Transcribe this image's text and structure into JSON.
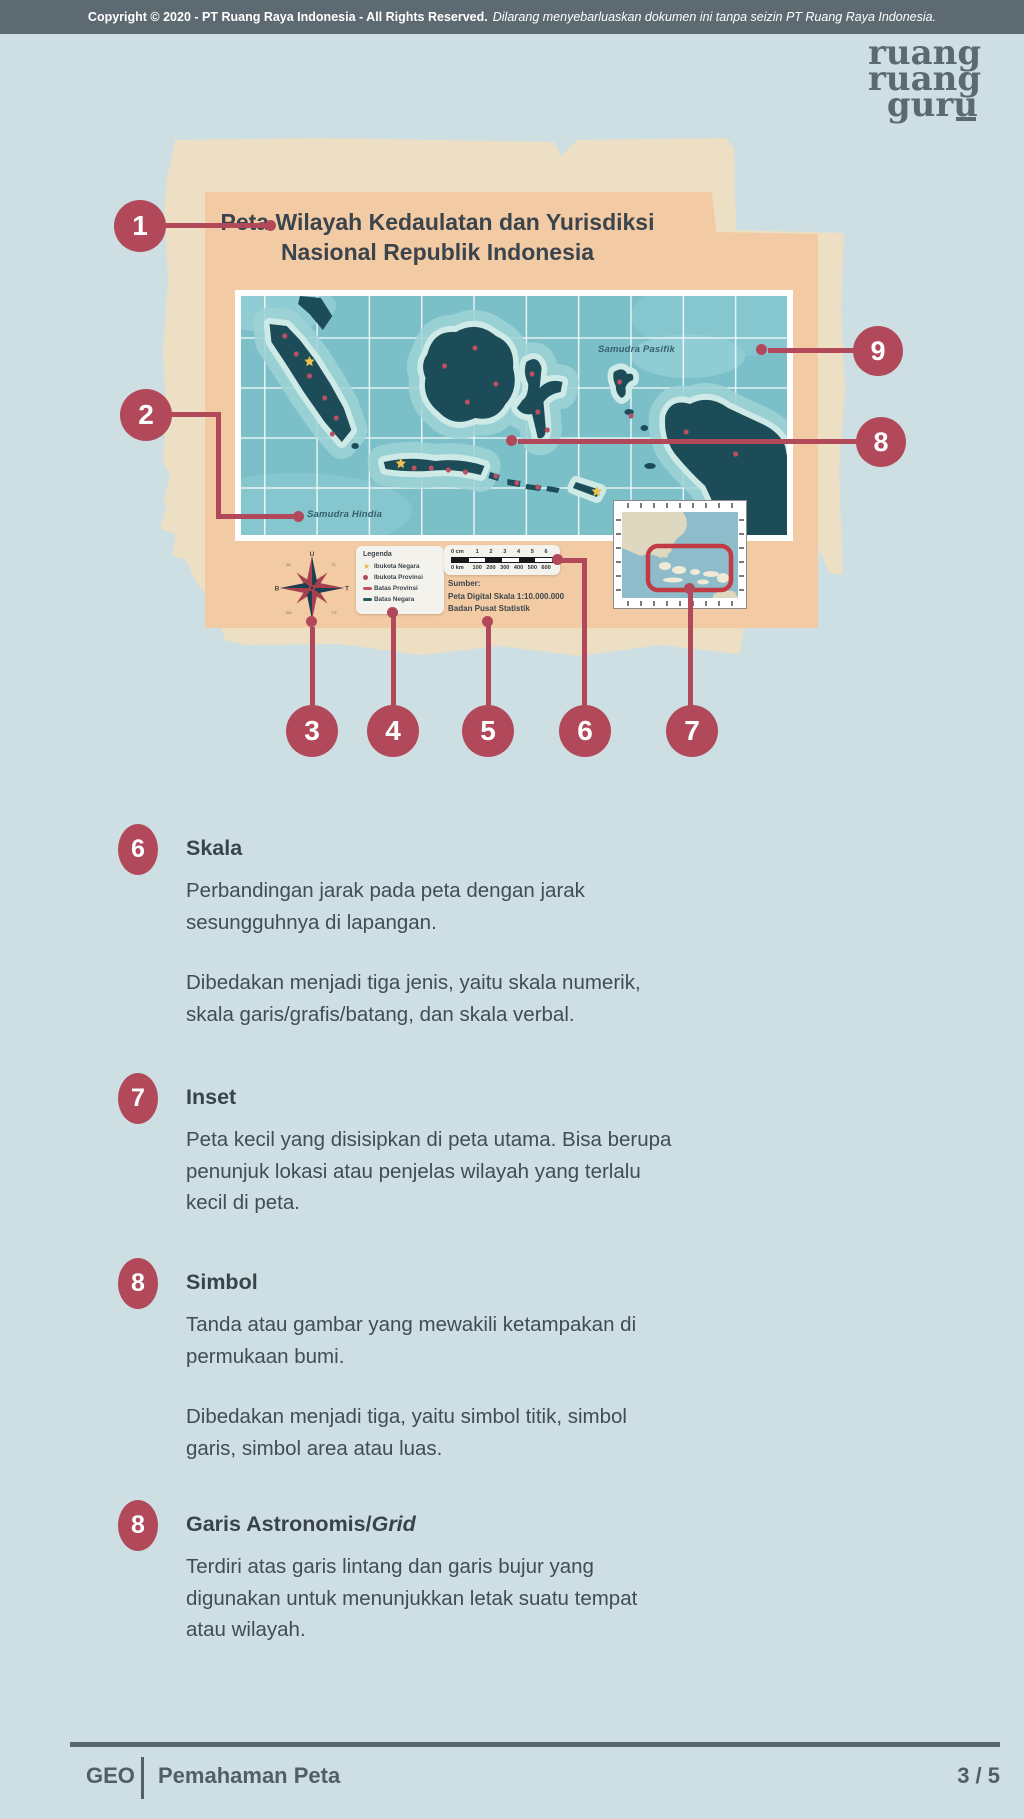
{
  "copyright_bar": {
    "bold": "Copyright © 2020 - PT Ruang Raya Indonesia - All Rights Reserved.",
    "italic": "Dilarang menyebarluaskan dokumen ini tanpa seizin PT Ruang Raya Indonesia."
  },
  "logo": {
    "line1": "ruang",
    "line2": "ruang",
    "line3": "guru"
  },
  "figure": {
    "title_line1": "Peta Wilayah Kedaulatan dan Yurisdiksi",
    "title_line2": "Nasional Republik Indonesia",
    "label_pacific": "Samudra Pasifik",
    "label_indian": "Samudra Hindia",
    "compass": {
      "n": "U",
      "e": "T",
      "s": "S",
      "w": "B",
      "ne": "TL",
      "se": "TG",
      "sw": "BD",
      "nw": "BL"
    },
    "legend": {
      "title": "Legenda",
      "items": [
        {
          "icon": "star",
          "label": "Ibukota Negara"
        },
        {
          "icon": "dot",
          "label": "Ibukota Provinsi"
        },
        {
          "icon": "line-red",
          "label": "Batas Provinsi"
        },
        {
          "icon": "line-teal",
          "label": "Batas Negara"
        }
      ]
    },
    "scalebar": {
      "cm": [
        "0 cm",
        "1",
        "2",
        "3",
        "4",
        "5",
        "6"
      ],
      "km": [
        "0 km",
        "100",
        "200",
        "300",
        "400",
        "500",
        "600"
      ]
    },
    "source_line1": "Sumber:",
    "source_line2": "Peta Digital Skala 1:10.000.000",
    "source_line3": "Badan Pusat Statistik",
    "callouts": {
      "c1": "1",
      "c2": "2",
      "c3": "3",
      "c4": "4",
      "c5": "5",
      "c6": "6",
      "c7": "7",
      "c8": "8",
      "c9": "9"
    }
  },
  "sections": [
    {
      "number": "6",
      "title": "Skala",
      "title_italic": "",
      "paragraphs": [
        "Perbandingan jarak pada peta dengan jarak\nsesungguhnya di lapangan.",
        "Dibedakan menjadi tiga jenis, yaitu skala numerik,\nskala garis/grafis/batang, dan skala verbal."
      ]
    },
    {
      "number": "7",
      "title": "Inset",
      "title_italic": "",
      "paragraphs": [
        "Peta kecil yang disisipkan di peta utama. Bisa berupa\npenunjuk lokasi atau penjelas wilayah yang terlalu\nkecil di peta."
      ]
    },
    {
      "number": "8",
      "title": "Simbol",
      "title_italic": "",
      "paragraphs": [
        "Tanda atau gambar yang mewakili ketampakan di\npermukaan bumi.",
        "Dibedakan menjadi tiga, yaitu simbol titik, simbol\ngaris, simbol area atau luas."
      ]
    },
    {
      "number": "8",
      "title": "Garis Astronomis/",
      "title_italic": "Grid",
      "paragraphs": [
        "Terdiri atas garis lintang dan garis bujur yang\ndigunakan untuk menunjukkan letak suatu tempat\natau wilayah."
      ]
    }
  ],
  "footer": {
    "subject": "GEO",
    "topic": "Pemahaman Peta",
    "page_number": "3 / 5"
  },
  "colors": {
    "accent": "#b1495a",
    "paper": "#ecdfc3",
    "peach": "#f2caa4",
    "sea": "#7bbfc9",
    "island": "#1d4c59",
    "bar": "#5d6a71",
    "page_bg": "#cedfe3"
  }
}
